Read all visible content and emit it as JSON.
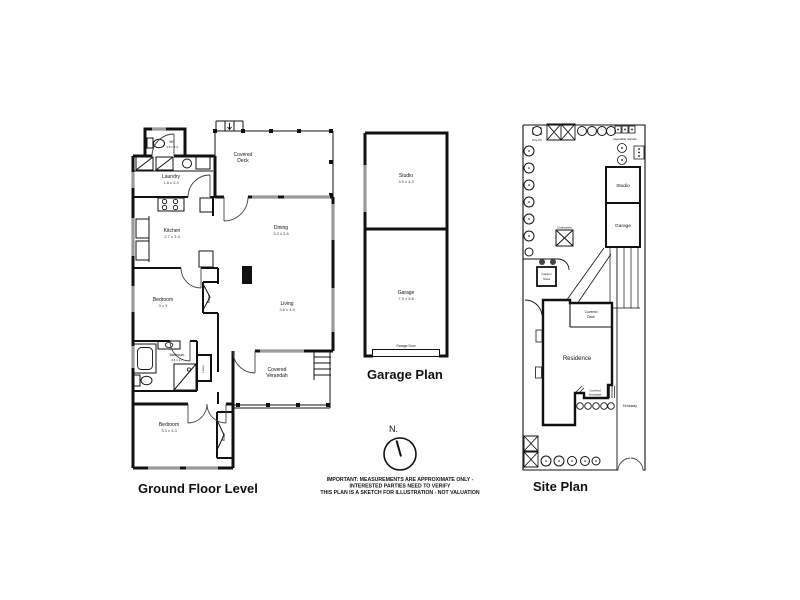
{
  "ground_floor": {
    "title": "Ground Floor Level",
    "rooms": {
      "wc": {
        "name": "WC",
        "dims": "1.6 x 2.4"
      },
      "laundry": {
        "name": "Laundry",
        "dims": "1.8 x 3.4"
      },
      "covered_deck": {
        "line1": "Covered",
        "line2": "Deck"
      },
      "kitchen": {
        "name": "Kitchen",
        "dims": "2.7 x 3.3"
      },
      "dining": {
        "name": "Dining",
        "dims": "3.2 x 3.6"
      },
      "bedroom1": {
        "name": "Bedroom",
        "dims": "3 x 3"
      },
      "robe1": {
        "name": "Robe"
      },
      "living": {
        "name": "Living",
        "dims": "3.6 x 3.9"
      },
      "bathroom": {
        "name": "Bathroom",
        "dims": "2.4 x 2.7"
      },
      "linen": {
        "name": "Linen"
      },
      "covered_verandah": {
        "line1": "Covered",
        "line2": "Verandah"
      },
      "bedroom2": {
        "name": "Bedroom",
        "dims": "3.3 x 3.3"
      },
      "robe2": {
        "name": "Robe"
      }
    }
  },
  "garage_plan": {
    "title": "Garage Plan",
    "rooms": {
      "studio": {
        "name": "Studio",
        "dims": "3.5 x 4.3"
      },
      "garage": {
        "name": "Garage",
        "dims": "7.5 x 3.8"
      },
      "garage_door": {
        "name": "Garage Door"
      }
    }
  },
  "site_plan": {
    "title": "Site Plan",
    "labels": {
      "fire_pit": "Fire Pit",
      "vegetable_garden": "Vegetable Garden",
      "studio": "Studio",
      "garage": "Garage",
      "clothesline": "Clothesline",
      "garden_shed_line1": "Garden",
      "garden_shed_line2": "Shed",
      "covered_deck_line1": "Covered",
      "covered_deck_line2": "Deck",
      "residence": "Residence",
      "covered_verandah_line1": "Covered",
      "covered_verandah_line2": "Verandah",
      "driveway": "Driveway"
    }
  },
  "compass": {
    "label": "N."
  },
  "disclaimer": {
    "line1": "IMPORTANT: MEASUREMENTS ARE APPROXIMATE ONLY -",
    "line2": "INTERESTED PARTIES NEED TO VERIFY",
    "line3": "THIS PLAN IS A SKETCH FOR ILLUSTRATION - NOT VALUATION"
  },
  "colors": {
    "wall": "#111111",
    "window": "#9a9a9a",
    "background": "#ffffff"
  }
}
